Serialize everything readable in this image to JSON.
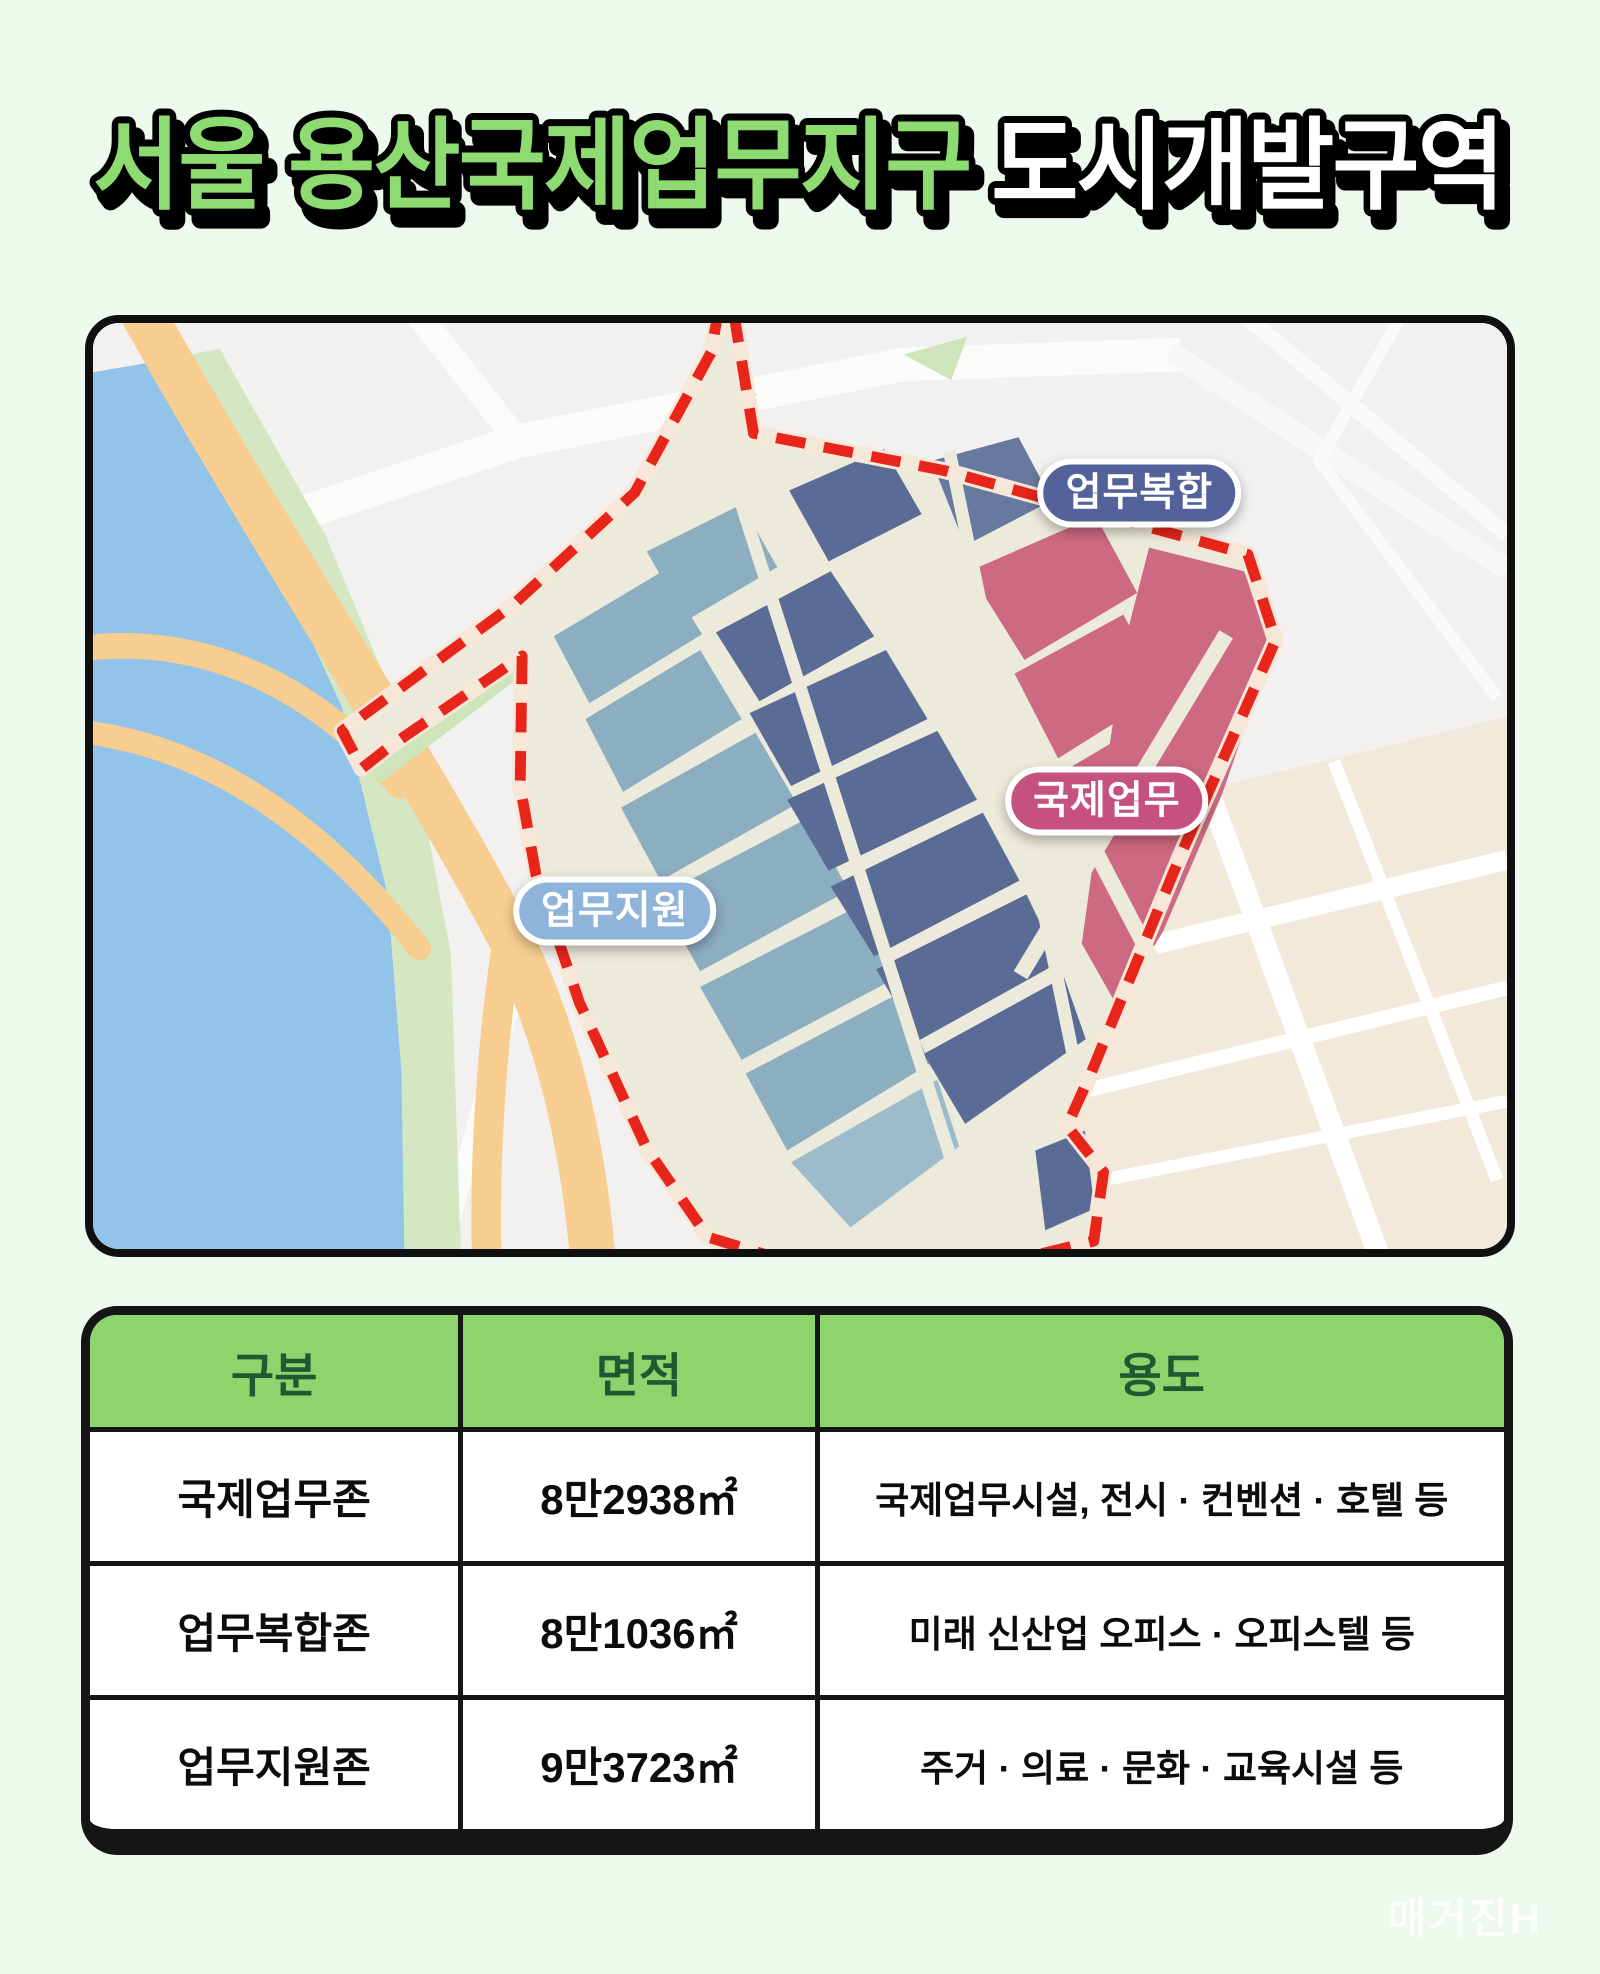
{
  "title": {
    "part1": "서울 용산국제업무지구",
    "part2": "도시개발구역",
    "part1_color": "#8edb72",
    "part2_color": "#ffffff",
    "outline_color": "#000000"
  },
  "map": {
    "boundary_color": "#e8251b",
    "district_fill": "#eceada",
    "labels": [
      {
        "text": "업무복합",
        "bg": "#53629b"
      },
      {
        "text": "국제업무",
        "bg": "#c5527e"
      },
      {
        "text": "업무지원",
        "bg": "#8fb4da"
      }
    ],
    "zone_colors": {
      "국제업무": "#cd6982",
      "업무복합": "#5a6b96",
      "업무지원": "#8caec1"
    },
    "features": {
      "river": "#92c3e9",
      "riverbank_green": "#d5e7c2",
      "highway": "#f7ce90",
      "city_blocks": "#f2e9db"
    }
  },
  "table": {
    "headers": [
      "구분",
      "면적",
      "용도"
    ],
    "header_bg": "#8cd56c",
    "header_text_color": "#1e5a31",
    "rows": [
      {
        "zone": "국제업무존",
        "area": "8만2938㎡",
        "use": "국제업무시설, 전시 · 컨벤션 · 호텔 등"
      },
      {
        "zone": "업무복합존",
        "area": "8만1036㎡",
        "use": "미래 신산업 오피스 · 오피스텔 등"
      },
      {
        "zone": "업무지원존",
        "area": "9만3723㎡",
        "use": "주거 · 의료 · 문화 · 교육시설 등"
      }
    ]
  },
  "watermark": "매거진H"
}
